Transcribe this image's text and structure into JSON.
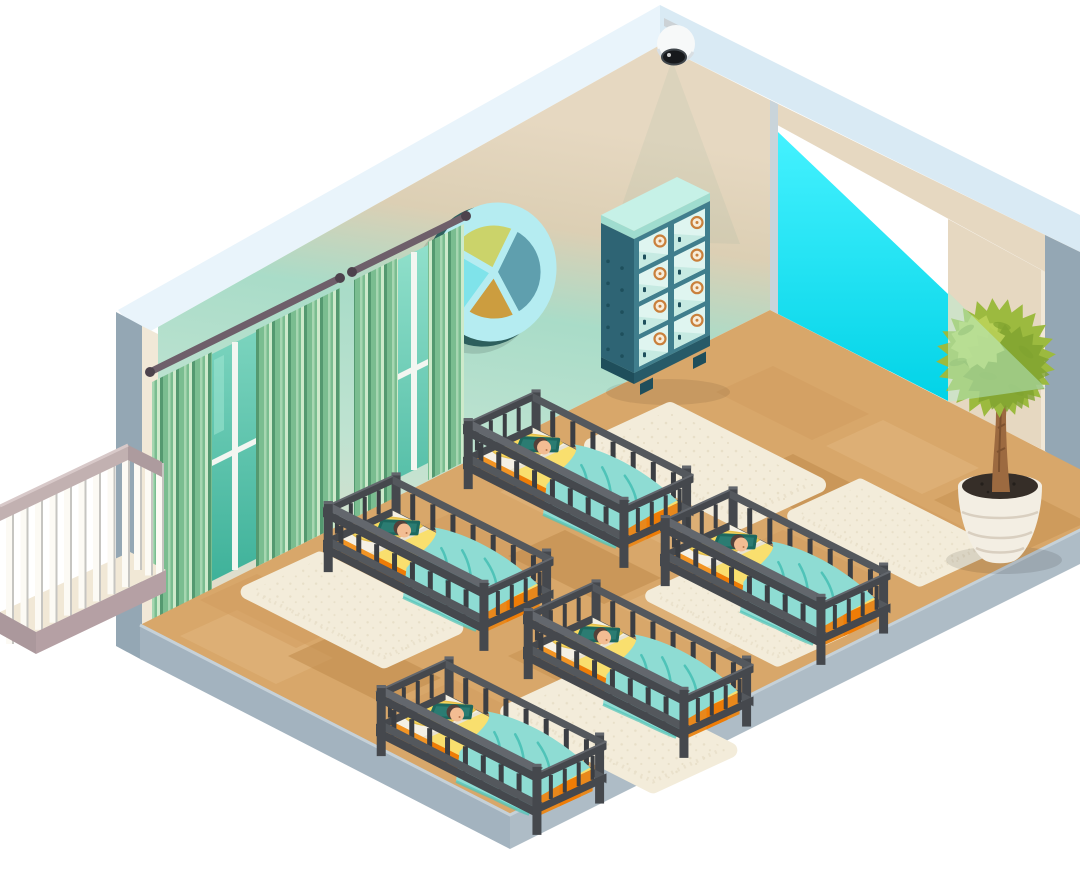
{
  "meta": {
    "description": "Isometric cutaway illustration of a nursery / daycare sleeping room with five cribs of sleeping babies, rugs, green curtained windows, a decorative porthole window, a locker cabinet, a potted topiary, a balcony railing and a ceiling security camera casting a cyan light beam through the open wall."
  },
  "palette": {
    "page_bg": "#ffffff",
    "fascia": "#e9f4fb",
    "fascia_shade": "#d9eaf4",
    "wall_beige": "#e6d8c1",
    "wall_beige_deep": "#dbc9ae",
    "wall_mint": "#a9dcc8",
    "wall_mint_light": "#c3e5d4",
    "wall_sand": "#e3ddcb",
    "wall_cut": "#f1e8d7",
    "wall_outer": "#94a7b4",
    "jamb": "#c9d4da",
    "opening_top": "#45f2ff",
    "opening_bottom": "#00d2e6",
    "beam": "#b8ecd0",
    "floor_base": "#d8a76a",
    "plank_light": "#e2b67e",
    "plank_mid": "#d19c5e",
    "plank_dark": "#c79250",
    "plank_deep": "#bf8a4a",
    "slab": "#a3b3bf",
    "slab_right": "#aebcc6",
    "slab_edge": "#c6d1d8",
    "rug": "#f3ecda",
    "rug_dot": "#e0d6bc",
    "crib_frame": "#45484d",
    "crib_frame_mid": "#54585d",
    "crib_frame_light": "#63676d",
    "crib_slat": "#3b3e43",
    "mattress_top": "#f9df6e",
    "sheet": "#f4f0e5",
    "mattress_side_orange": "#f29424",
    "mattress_side_bright": "#ee7c06",
    "mattress_side_yellow": "#f8d95e",
    "blanket": "#8edcd3",
    "blanket_fold": "#4fc3b8",
    "pillow_yellow": "#f8d95f",
    "pillow_yellow_edge": "#e5bf4b",
    "pillow_teal": "#2b7c72",
    "pillow_teal_edge": "#1d685f",
    "skin": "#f3bd93",
    "hair": "#54413a",
    "curtain_a": "#549970",
    "curtain_b": "#7abd90",
    "curtain_c": "#a6d6b1",
    "curtain_hi": "#cdeacb",
    "glass": "#3aaf97",
    "glass_hi": "#9fe5d2",
    "mullion": "#f3f6f1",
    "rod": "#6e5f6a",
    "cab_top": "#c6f1e7",
    "cab_bevel": "#9fdccf",
    "cab_side": "#2e6474",
    "cab_frame": "#407e8d",
    "cab_cell": "#dff5f0",
    "cab_cell_shadow": "#c2e7df",
    "badge": "#c9803c",
    "badge_fill": "#f7ecd9",
    "rivet": "#1e4f5c",
    "pot": "#f3eee3",
    "pot_line": "#d9cfc0",
    "soil": "#362e28",
    "trunk": "#9c6a40",
    "trunk_dark": "#7d5230",
    "leaf": "#9cba3f",
    "leaf_dark": "#7fa22f",
    "leaf_light": "#bdd35b",
    "rail_white": "#fcfaf4",
    "rail_shade": "#c6c5c1",
    "rail_top": "#c2b1b1",
    "rail_top_dark": "#ad9b9e",
    "rail_base": "#b5a0a4",
    "balcony": "#f1e8d6",
    "cam_body": "#f7f9f9",
    "cam_gray": "#ccd2d6",
    "cam_lens": "#17191c",
    "porthole_rim": "#b5ecf1",
    "porthole_back": "#2d5f5d",
    "seg_slate": "#5f9fae",
    "seg_lime": "#cbd36a",
    "seg_gold": "#cc9d3f",
    "seg_cyan": "#7fe3ea"
  },
  "scene": {
    "room": "nursery sleeping room (isometric cutaway)",
    "objects": [
      {
        "name": "security-camera",
        "count": 1,
        "note": "white dome camera at ceiling peak with cyan light beam"
      },
      {
        "name": "porthole-window",
        "count": 1,
        "segments": [
          "slate-blue",
          "gold",
          "cyan",
          "lime"
        ]
      },
      {
        "name": "curtained-window",
        "count": 2,
        "curtain_style": "green vertical stripes"
      },
      {
        "name": "locker-cabinet",
        "count": 1,
        "cells": 8,
        "cell_badges": "orange rings"
      },
      {
        "name": "crib-with-sleeping-baby",
        "count": 5,
        "bedding": [
          "yellow mattress",
          "orange side",
          "teal blanket",
          "yellow pillow",
          "teal pillow"
        ]
      },
      {
        "name": "fluffy-rug",
        "count": 5
      },
      {
        "name": "potted-topiary",
        "count": 1
      },
      {
        "name": "balcony-railing",
        "count": 1
      },
      {
        "name": "wood-plank-floor",
        "count": 1
      }
    ]
  }
}
